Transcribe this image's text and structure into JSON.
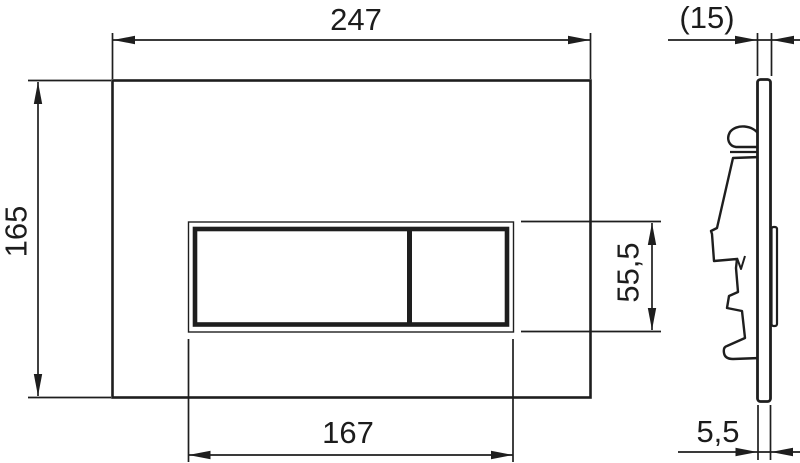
{
  "drawing": {
    "description": "Dimensioned technical drawing of a WC flush actuation plate: front view and side profile view",
    "front_view": {
      "plate_width_label": "247",
      "plate_height_label": "165",
      "button_width_label": "167",
      "button_height_label": "55,5"
    },
    "side_view": {
      "depth_label": "(15)",
      "thickness_label": "5,5"
    },
    "dimensions_mm": {
      "plate_width": 247,
      "plate_height": 165,
      "button_cutout_width": 167,
      "button_cutout_height": 55.5,
      "overall_depth_reference": 15,
      "plate_thickness": 5.5
    },
    "colors": {
      "line": "#1e1e1e",
      "background": "#ffffff"
    }
  }
}
